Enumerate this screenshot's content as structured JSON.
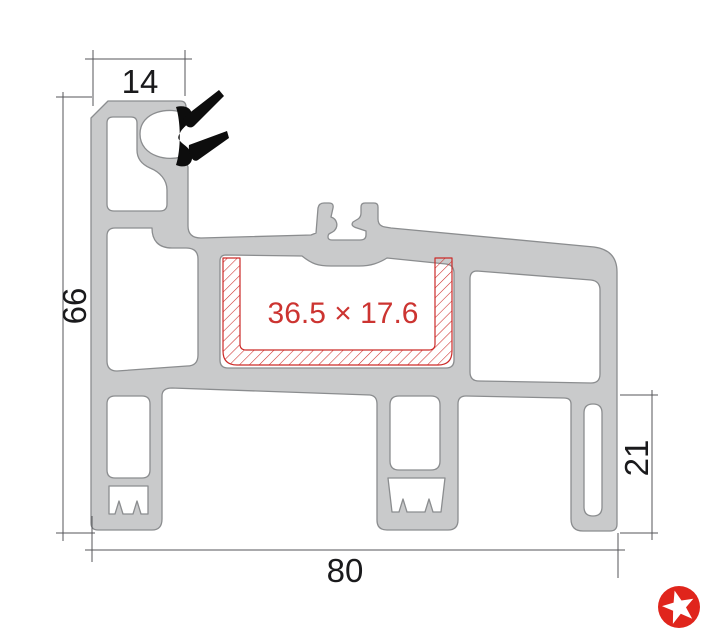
{
  "drawing": {
    "dimensions": {
      "top_width": "14",
      "overall_height": "66",
      "overall_width": "80",
      "right_height": "21"
    },
    "chamber": {
      "label": "36.5 × 17.6"
    },
    "colors": {
      "aluminum_fill": "#c9cacb",
      "aluminum_outline": "#8b8d8f",
      "dimension_line": "#55565a",
      "dimension_text": "#1a1a1c",
      "hatch_red": "#cc2a28",
      "label_red": "#cc3431",
      "gasket_black": "#0d0d0d",
      "logo_red": "#e0251c",
      "background": "#ffffff"
    },
    "icons": {
      "logo": "star-icon"
    }
  }
}
